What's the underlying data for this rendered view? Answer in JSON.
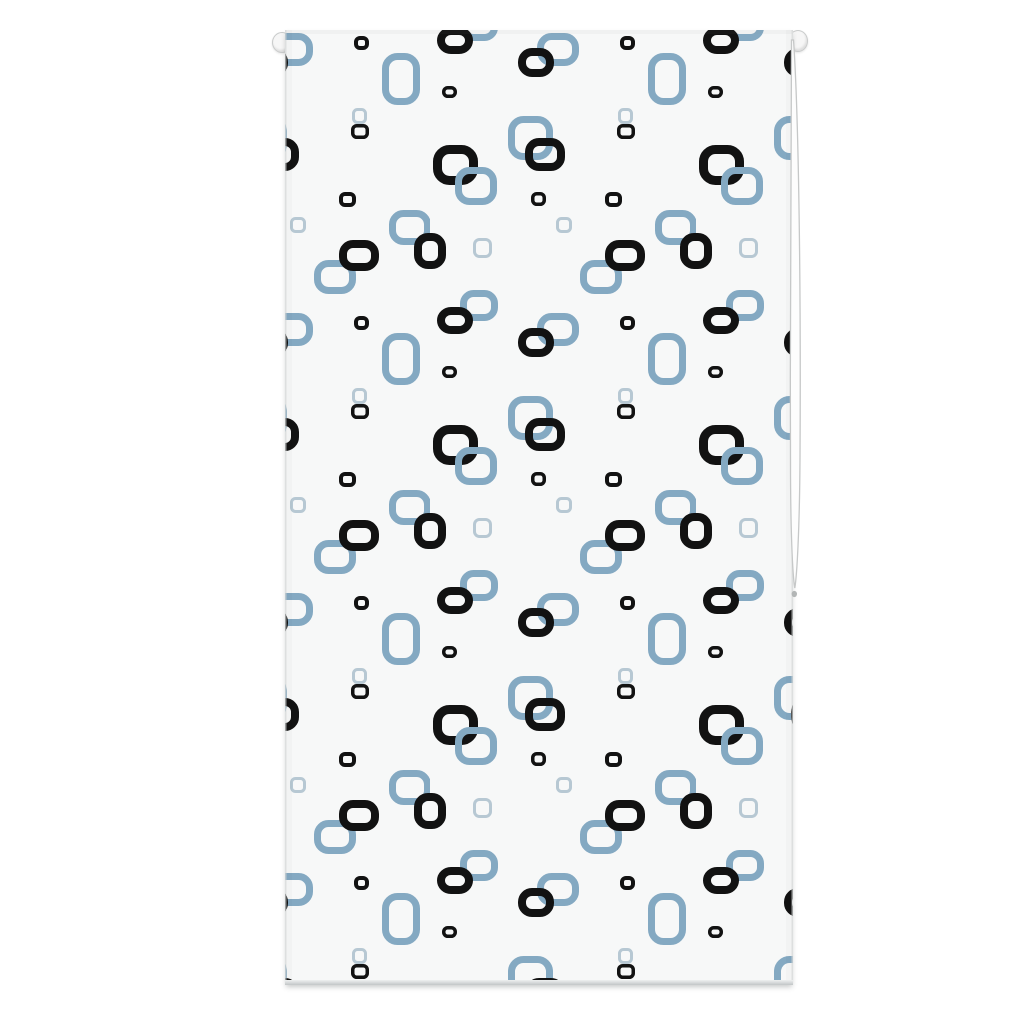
{
  "scene": {
    "subject": "roller blind product photo",
    "background_color": "#ffffff"
  },
  "blind": {
    "left": 285,
    "top": 30,
    "width": 508,
    "height": 955,
    "fabric_color": "#f7f8f8",
    "edge_line_color": "#d8dcdc",
    "top_shade_color": "#8a9090",
    "hem_color_top": "#eef0f0",
    "hem_color_bottom": "#c2c6c7"
  },
  "pins": {
    "left": {
      "x": 272,
      "y": 32,
      "w": 18,
      "h": 19
    },
    "right": {
      "x": 788,
      "y": 30,
      "w": 18,
      "h": 20
    },
    "fill": "#f6f6f6",
    "stroke": "#c9cbcb"
  },
  "cord": {
    "x": 780,
    "y": 30,
    "w": 30,
    "h": 605,
    "loop_fill": "#fdfdfd",
    "loop_stroke": "#c6c8c8",
    "bead_color": "#b3b6b6"
  },
  "pattern": {
    "tile_width": 266,
    "tile_height": 280,
    "offset_x": 145,
    "offset_y": 100,
    "colors": {
      "black": "#121212",
      "blue": "#84a9c2",
      "light": "#b7c8d3"
    },
    "squares": [
      {
        "x": 78,
        "y": -14,
        "w": 45,
        "h": 44,
        "color": "blue",
        "stroke": 7,
        "rx": 12
      },
      {
        "x": 78,
        "y": 266,
        "w": 45,
        "h": 44,
        "color": "blue",
        "stroke": 7,
        "rx": 12
      },
      {
        "x": 95,
        "y": 8,
        "w": 40,
        "h": 33,
        "color": "black",
        "stroke": 8,
        "rx": 10
      },
      {
        "x": 3,
        "y": 15,
        "w": 45,
        "h": 40,
        "color": "black",
        "stroke": 9,
        "rx": 12
      },
      {
        "x": 25,
        "y": 37,
        "w": 42,
        "h": 38,
        "color": "blue",
        "stroke": 7,
        "rx": 11
      },
      {
        "x": 187,
        "y": -6,
        "w": 18,
        "h": 15,
        "color": "black",
        "stroke": 3.5,
        "rx": 4
      },
      {
        "x": 187,
        "y": 274,
        "w": 18,
        "h": 15,
        "color": "black",
        "stroke": 3.5,
        "rx": 4
      },
      {
        "x": 188,
        "y": 258,
        "w": 15,
        "h": 16,
        "color": "light",
        "stroke": 3,
        "rx": 4
      },
      {
        "x": 101,
        "y": 62,
        "w": 15,
        "h": 14,
        "color": "black",
        "stroke": 3.5,
        "rx": 4
      },
      {
        "x": 175,
        "y": 62,
        "w": 17,
        "h": 15,
        "color": "black",
        "stroke": 4,
        "rx": 4
      },
      {
        "x": 225,
        "y": 80,
        "w": 42,
        "h": 35,
        "color": "blue",
        "stroke": 7,
        "rx": 11
      },
      {
        "x": 250,
        "y": 103,
        "w": 32,
        "h": 36,
        "color": "black",
        "stroke": 8,
        "rx": 10
      },
      {
        "x": -16,
        "y": 103,
        "w": 32,
        "h": 36,
        "color": "black",
        "stroke": 8,
        "rx": 10
      },
      {
        "x": 43,
        "y": 108,
        "w": 19,
        "h": 20,
        "color": "light",
        "stroke": 3,
        "rx": 5
      },
      {
        "x": 126,
        "y": 87,
        "w": 16,
        "h": 16,
        "color": "light",
        "stroke": 3,
        "rx": 4
      },
      {
        "x": 150,
        "y": 130,
        "w": 42,
        "h": 34,
        "color": "blue",
        "stroke": 7,
        "rx": 11
      },
      {
        "x": 175,
        "y": 110,
        "w": 40,
        "h": 31,
        "color": "black",
        "stroke": 8,
        "rx": 10
      },
      {
        "x": 30,
        "y": 160,
        "w": 38,
        "h": 31,
        "color": "blue",
        "stroke": 7,
        "rx": 10
      },
      {
        "x": 7,
        "y": 177,
        "w": 36,
        "h": 27,
        "color": "black",
        "stroke": 8,
        "rx": 10
      },
      {
        "x": 107,
        "y": 183,
        "w": 42,
        "h": 33,
        "color": "blue",
        "stroke": 7,
        "rx": 11
      },
      {
        "x": 88,
        "y": 198,
        "w": 36,
        "h": 29,
        "color": "black",
        "stroke": 8,
        "rx": 10
      },
      {
        "x": 190,
        "y": 186,
        "w": 15,
        "h": 14,
        "color": "black",
        "stroke": 4,
        "rx": 4
      },
      {
        "x": 218,
        "y": 203,
        "w": 38,
        "h": 52,
        "color": "blue",
        "stroke": 7,
        "rx": 12
      },
      {
        "x": 12,
        "y": 236,
        "w": 15,
        "h": 12,
        "color": "black",
        "stroke": 3.5,
        "rx": 4
      }
    ]
  }
}
